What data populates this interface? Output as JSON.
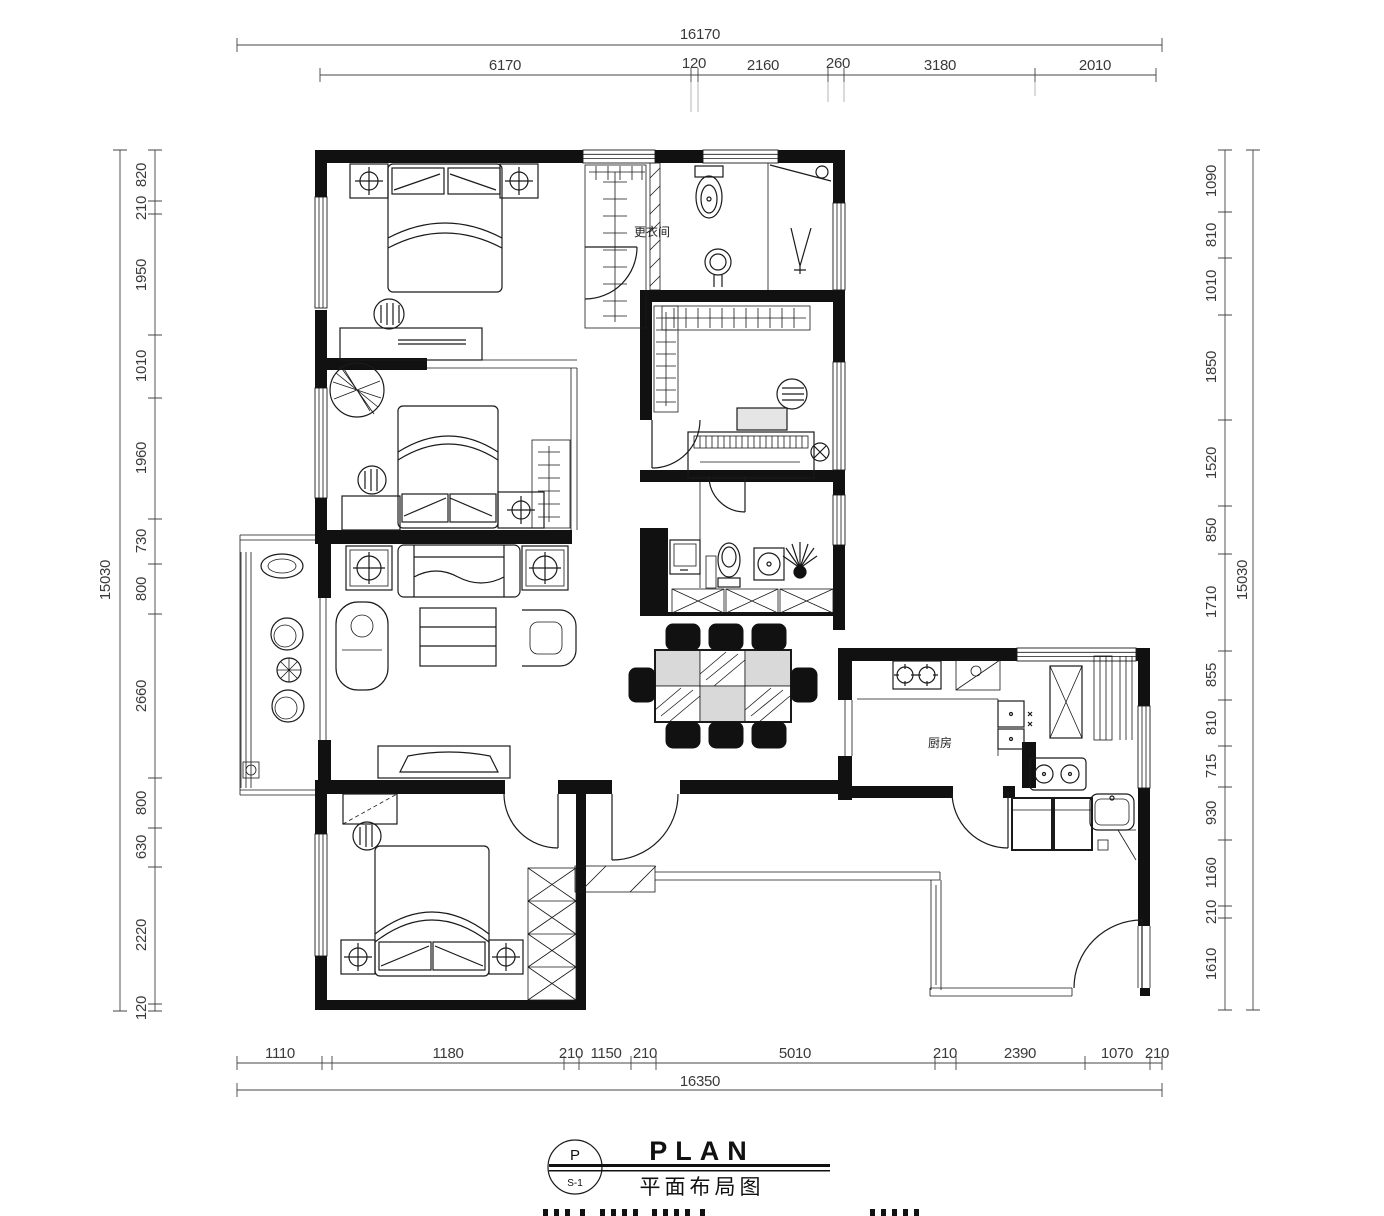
{
  "dimensions": {
    "top": {
      "total": "16170",
      "segments": [
        "6170",
        "120",
        "2160",
        "260",
        "3180",
        "2010"
      ]
    },
    "bottom": {
      "total": "16350",
      "segments": [
        "1110",
        "1180",
        "210",
        "1150",
        "210",
        "5010",
        "210",
        "2390",
        "1070",
        "210"
      ]
    },
    "left": {
      "total": "15030",
      "segments": [
        "820",
        "210",
        "1950",
        "1010",
        "1960",
        "730",
        "800",
        "2660",
        "800",
        "630",
        "2220",
        "120"
      ]
    },
    "right": {
      "total": "15030",
      "segments": [
        "1090",
        "810",
        "1010",
        "1850",
        "1520",
        "850",
        "1710",
        "855",
        "810",
        "715",
        "930",
        "1160",
        "210",
        "1610"
      ]
    }
  },
  "room_labels": {
    "kitchen": "厨房",
    "dressing_room": "更衣间"
  },
  "title_block": {
    "plan_en": "PLAN",
    "plan_cn": "平面布局图",
    "bubble_top": "P",
    "bubble_bottom": "S-1"
  },
  "colors": {
    "ink": "#1a1a1a",
    "paper": "#ffffff"
  }
}
